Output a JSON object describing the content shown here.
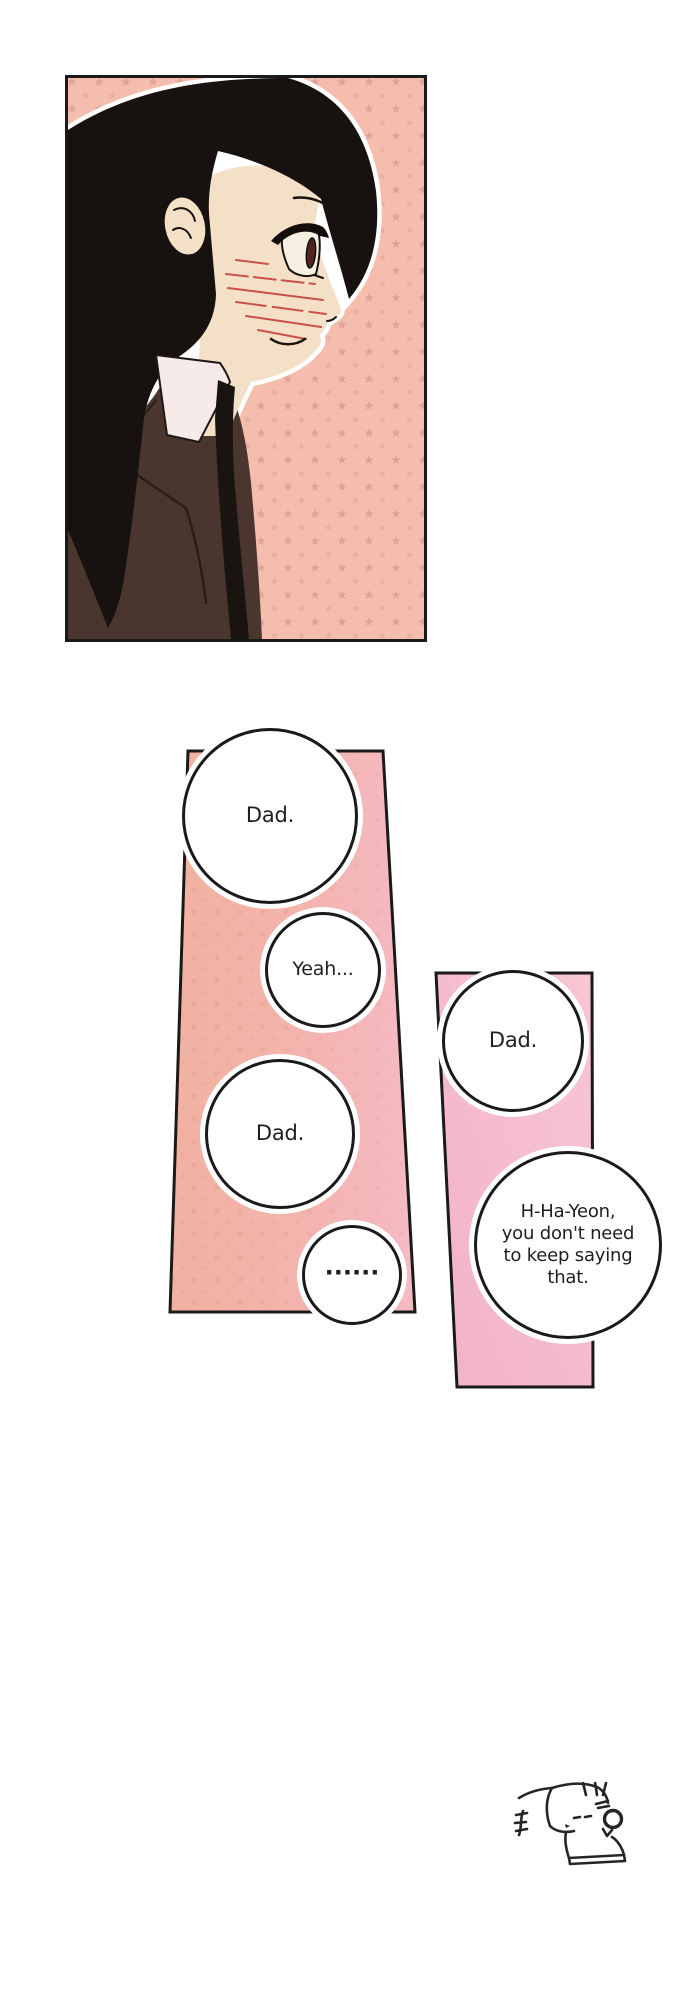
{
  "page": {
    "width": 690,
    "height": 2000,
    "background": "#ffffff"
  },
  "colors": {
    "page-bg": "#ffffff",
    "line": "#1a1a1a",
    "ink": "#262626",
    "text": "#1f1f1f",
    "bubble-bg": "#ffffff",
    "panel1-bg": "#f5bdad",
    "panel1-star": "#d7978c",
    "panel2-left": "#f2b1a0",
    "panel2-mid": "#f3b4ae",
    "panel2-right": "#f5bac4",
    "panel2-star": "#dd9a8b",
    "panel3-top": "#f8c6d4",
    "panel3-bottom": "#f2b2c6",
    "hair": "#17120f",
    "skin": "#f4e0c6",
    "jacket": "#4a362e",
    "jacket-seam": "#2a1d18",
    "shirt": "#f6ebe8",
    "tie": "#1a1411",
    "blush": "#c8514a",
    "iris": "#53241e",
    "sclera": "#f6f0e3"
  },
  "panels": {
    "panel1": {
      "description": "Close-up side profile of a girl with long black hair in a brown blazer and tie, blushing, on a salmon star-pattern background"
    },
    "panel2": {
      "description": "Skewed salmon-pink star-pattern panel holding four speech bubbles"
    },
    "panel3": {
      "description": "Skewed plain pink panel holding two speech bubbles"
    }
  },
  "bubbles": [
    {
      "text": "Dad."
    },
    {
      "text": "Yeah..."
    },
    {
      "text": "Dad."
    },
    {
      "text": "......"
    },
    {
      "text": "Dad."
    },
    {
      "text": "H-Ha-Yeon, you don't need to keep saying that.",
      "lines": [
        "H-Ha-Yeon,",
        "you don't need",
        "to keep saying",
        "that."
      ]
    }
  ],
  "doodle": {
    "description": "small startled chibi doodle with trembling marks"
  }
}
